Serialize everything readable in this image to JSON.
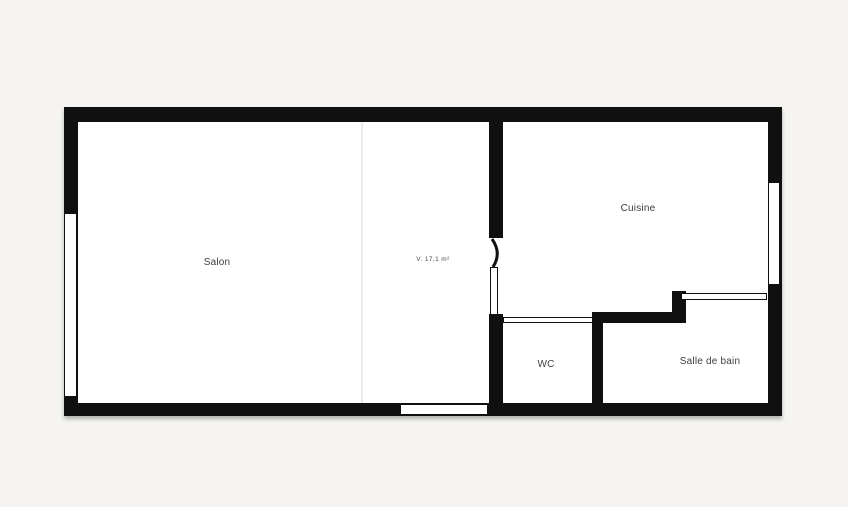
{
  "plan": {
    "background_color": "#f5f4f1",
    "wall_color": "#101010",
    "floor_color": "#ffffff",
    "divider_color": "#ebebeb",
    "label_color": "#3e3e3e",
    "rooms": {
      "salon": {
        "label": "Salon"
      },
      "center_area": {
        "label": "V. 17,1 m²"
      },
      "cuisine": {
        "label": "Cuisine"
      },
      "wc": {
        "label": "WC"
      },
      "salle_de_bain": {
        "label": "Salle de bain"
      }
    }
  }
}
